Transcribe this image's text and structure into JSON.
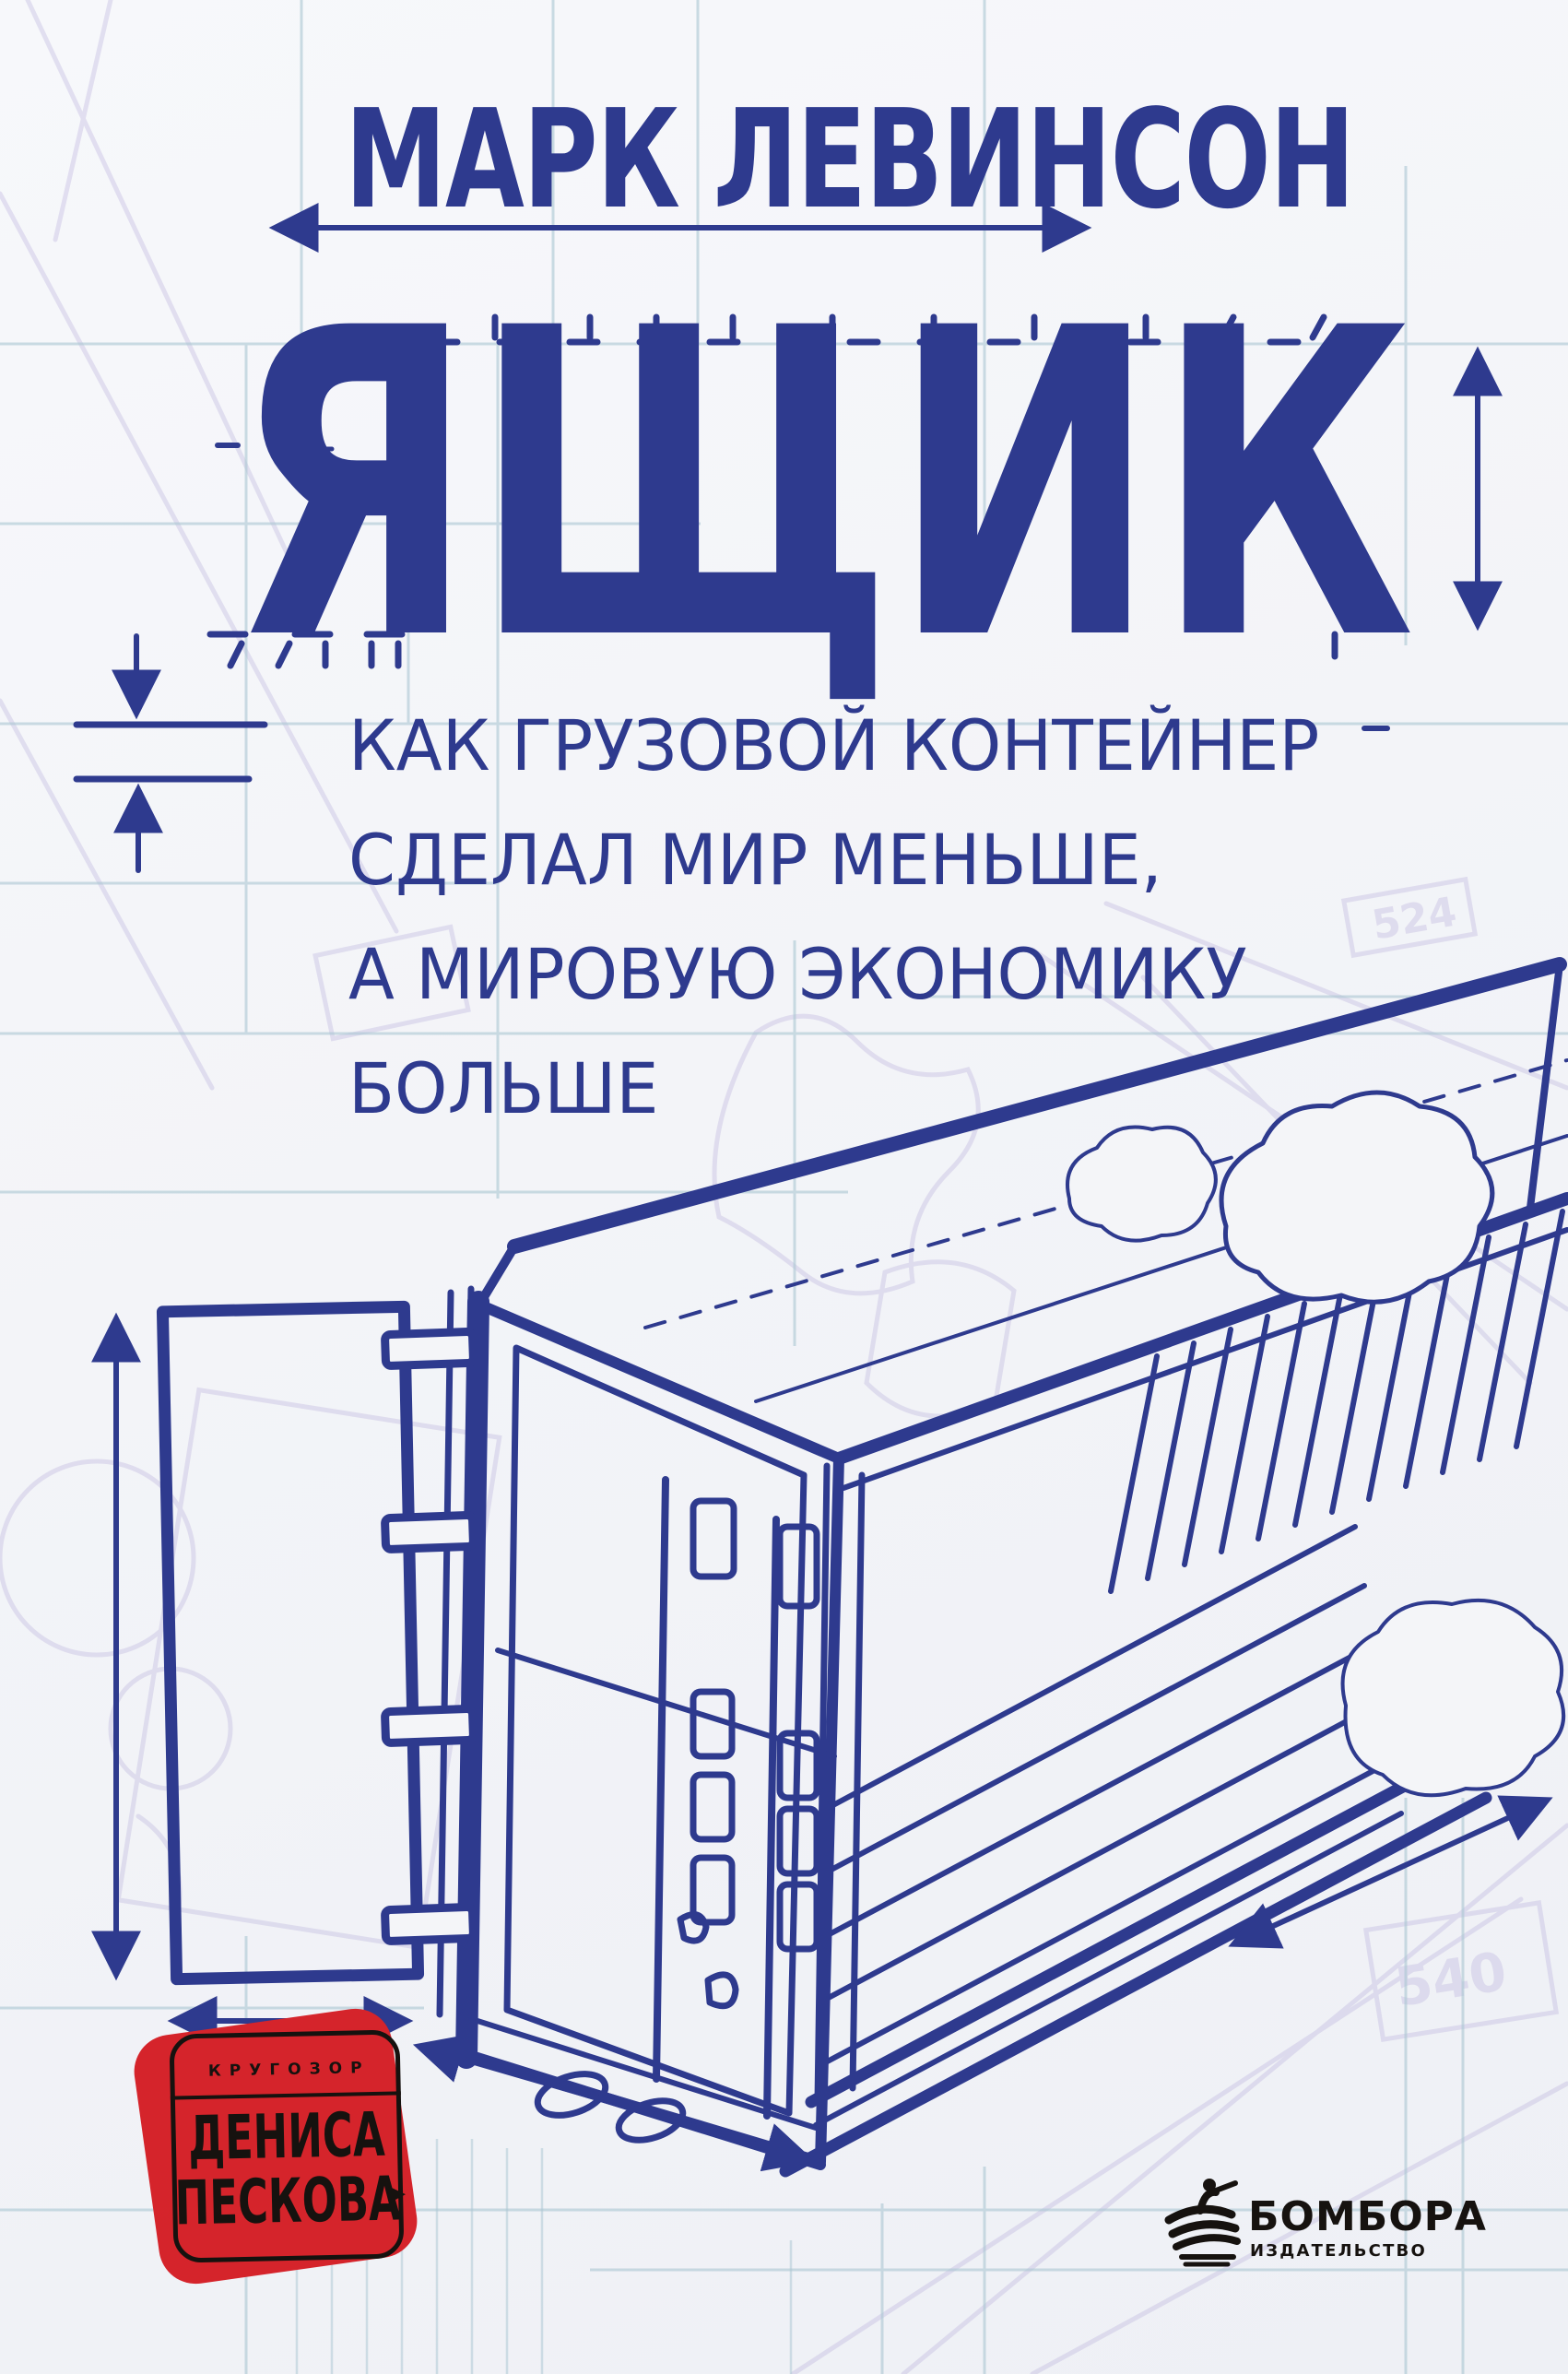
{
  "cover": {
    "author": "МАРК ЛЕВИНСОН",
    "title": "ЯЩИК",
    "subtitle_lines": [
      "КАК ГРУЗОВОЙ КОНТЕЙНЕР",
      "СДЕЛАЛ МИР МЕНЬШЕ,",
      "А МИРОВУЮ ЭКОНОМИКУ",
      "БОЛЬШЕ"
    ]
  },
  "badge": {
    "series_label": "КРУГОЗОР",
    "name_line1": "ДЕНИСА",
    "name_line2": "ПЕСКОВА",
    "arrow_icon": "▶"
  },
  "publisher": {
    "name": "БОМБОРА",
    "role": "ИЗДАТЕЛЬСТВО"
  },
  "blueprint": {
    "label_a": "524",
    "label_b": "540"
  },
  "colors": {
    "navy": "#2e3a8e",
    "grid_blue": "#aac6d2",
    "sketch_lavender": "#b6aed9",
    "badge_red": "#d5242b",
    "ink_black": "#16120f",
    "paper": "#f4f5f8"
  }
}
